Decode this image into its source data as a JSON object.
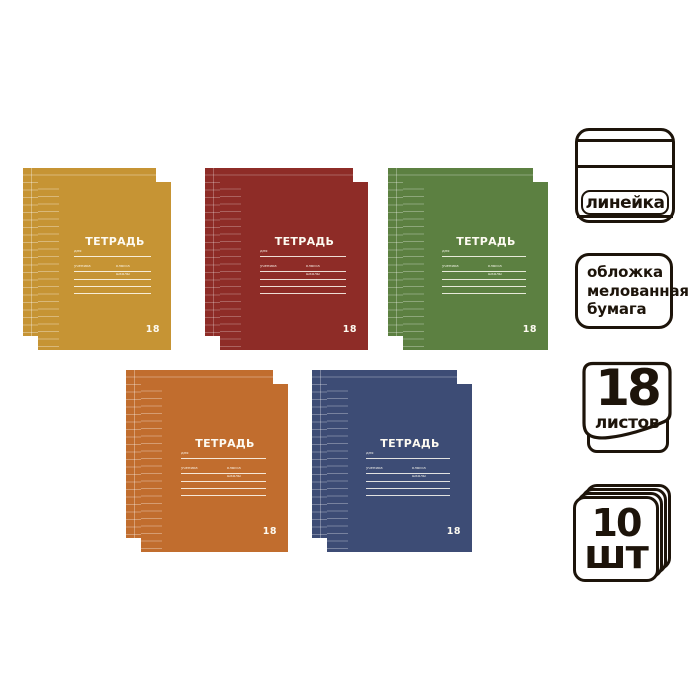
{
  "page": {
    "background": "#ffffff",
    "ink_color": "#1d140a"
  },
  "cover": {
    "title": "ТЕТРАДЬ",
    "field_for": "для",
    "field_student": "ученика",
    "field_class": "класса",
    "field_school": "школы",
    "sheet_count": "18"
  },
  "notebooks": [
    {
      "name": "yellow",
      "cover_color": "#c69434",
      "style_vars": "--cover:#c69434;--rl:rgba(255,255,255,.34)"
    },
    {
      "name": "red",
      "cover_color": "#8e2c27",
      "style_vars": "--cover:#8e2c27;--rl:rgba(255,255,255,.26)"
    },
    {
      "name": "green",
      "cover_color": "#5c8041",
      "style_vars": "--cover:#5c8041;--rl:rgba(255,255,255,.30)"
    },
    {
      "name": "orange",
      "cover_color": "#c16d2e",
      "style_vars": "--cover:#c16d2e;--rl:rgba(255,255,255,.32)"
    },
    {
      "name": "blue",
      "cover_color": "#3d4c75",
      "style_vars": "--cover:#3d4c75;--rl:rgba(255,255,255,.30)"
    }
  ],
  "badges": {
    "ruling": {
      "label": "линейка"
    },
    "cover_material": {
      "line1": "обложка",
      "line2": "мелованная",
      "line3": "бумага"
    },
    "sheets": {
      "count": "18",
      "unit": "листов"
    },
    "quantity": {
      "count": "10",
      "unit": "шт"
    }
  }
}
